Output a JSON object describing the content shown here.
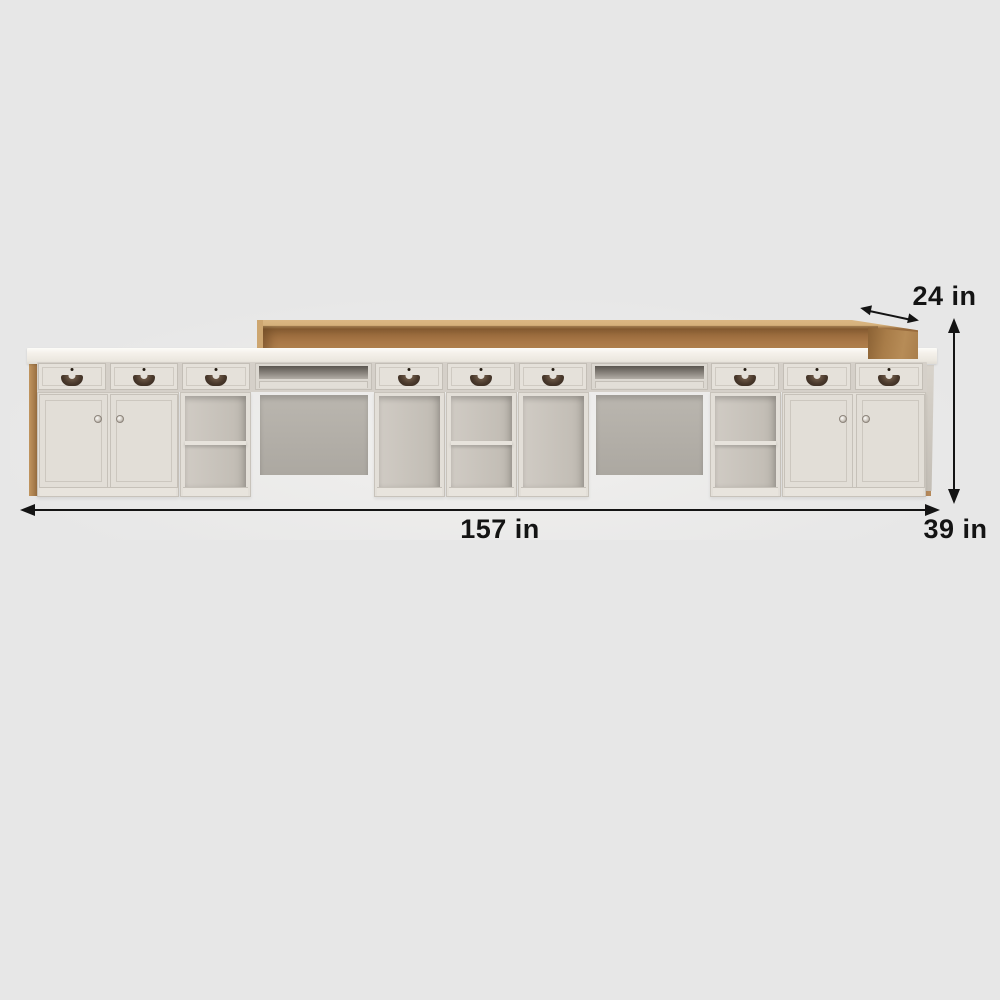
{
  "annotations": {
    "width_label": "157 in",
    "height_label": "39 in",
    "depth_label": "24 in"
  },
  "icons": {
    "width_arrow": "double-headed-horizontal-arrow",
    "height_arrow": "double-headed-vertical-arrow",
    "depth_arrow": "double-headed-diagonal-arrow",
    "drawer_handle": "half-moon-shell-pull",
    "drawer_keyhole": "round-keyhole-dot",
    "door_knob": "round-metal-knob"
  },
  "palette": {
    "background": "#e7e7e7",
    "annotation_color": "#141414",
    "wood": "#aa7946",
    "wood_light": "#dab783",
    "cabinet_body": "#e3dfd8",
    "knee_panel": "#b3afa8",
    "handle": "#46362a"
  }
}
